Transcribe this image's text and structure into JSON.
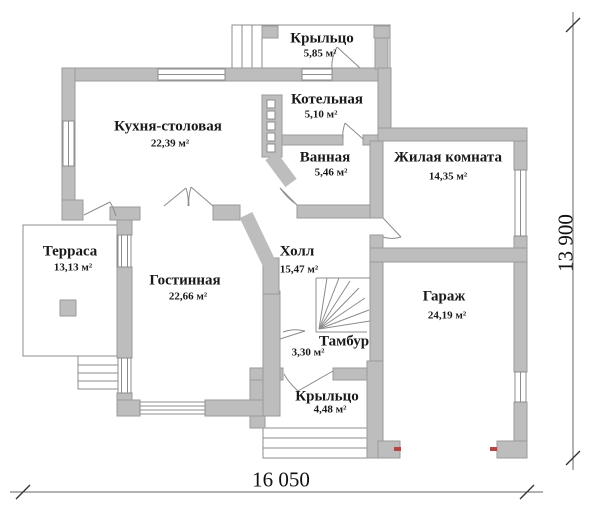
{
  "plan": {
    "title": "План первого этажа",
    "rooms": [
      {
        "id": "porch-top",
        "name": "Крыльцо",
        "area": "5,85 м²"
      },
      {
        "id": "boiler",
        "name": "Котельная",
        "area": "5,10 м²"
      },
      {
        "id": "kitchen",
        "name": "Кухня-столовая",
        "area": "22,39 м²"
      },
      {
        "id": "bathroom",
        "name": "Ванная",
        "area": "5,46 м²"
      },
      {
        "id": "living-room",
        "name": "Жилая комната",
        "area": "14,35 м²"
      },
      {
        "id": "terrace",
        "name": "Терраса",
        "area": "13,13 м²"
      },
      {
        "id": "hall",
        "name": "Холл",
        "area": "15,47 м²"
      },
      {
        "id": "lounge",
        "name": "Гостинная",
        "area": "22,66 м²"
      },
      {
        "id": "garage",
        "name": "Гараж",
        "area": "24,19 м²"
      },
      {
        "id": "vestibule",
        "name": "Тамбур",
        "area": "3,30 м²"
      },
      {
        "id": "porch-bottom",
        "name": "Крыльцо",
        "area": "4,48 м²"
      }
    ],
    "dimensions": {
      "width": "16 050",
      "height": "13 900"
    },
    "colors": {
      "wall": "#bdbdbd",
      "wall_edge": "#9a9a9a",
      "line": "#8c8c8c",
      "dim_line": "#666666",
      "accent_red": "#b34545",
      "text": "#191919"
    }
  }
}
